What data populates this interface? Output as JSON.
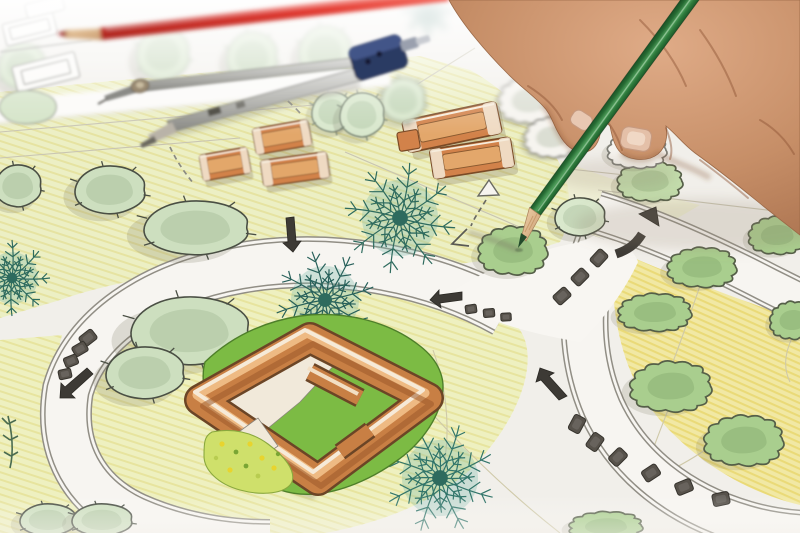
{
  "scene": {
    "type": "photograph",
    "subject": "Hand of a landscape architect drawing a garden design plan with a green colored pencil",
    "tools": {
      "hand": {
        "label": "right hand holding pencil",
        "skin_color": "#c68e67"
      },
      "green_pencil": {
        "label": "green colored pencil",
        "body_color": "#2e7d3c",
        "tip": "sharpened wood tip touching a shrub"
      },
      "red_pencil": {
        "label": "red colored pencil",
        "body_color": "#d93a31"
      },
      "compass": {
        "label": "drafting divider compass",
        "handle_color": "#2c3a63",
        "metal_color": "#b9b9b5"
      }
    },
    "drawing": {
      "label": "hand-drawn landscape architecture blueprint",
      "paper_color": "#f1efea",
      "elements": {
        "lawns": {
          "label": "colored-pencil lawn areas",
          "colors": [
            "#ecefc4",
            "#f1e8a4"
          ]
        },
        "walkways": {
          "label": "curved double-edged walkways",
          "color": "#f7f5f1",
          "edge_color": "#918e85"
        },
        "round_trees": {
          "label": "round canopy trees",
          "fill": "#cddfbf",
          "count": 15
        },
        "scalloped_shrubs": {
          "label": "scalloped green shrubs",
          "fill": "#a9ce8e",
          "count": 9
        },
        "outline_shrubs": {
          "label": "uncolored outline shrubs",
          "fill": "#f6f4ef",
          "count": 5
        },
        "conifers": {
          "label": "feathery conifer plants",
          "color": "#2e6b5e",
          "count": 5
        },
        "building_blocks": {
          "label": "small orange buildings",
          "color": "#d2824a",
          "count": 6
        },
        "courtyard_building": {
          "label": "large orange courtyard building",
          "color": "#c87f44",
          "hedge_color": "#7cbb44"
        },
        "flower_bed": {
          "label": "yellow flower bed",
          "colors": [
            "#cfe06b",
            "#e8d42e"
          ]
        },
        "stepping_stones": {
          "label": "stepping stones",
          "color": "#57524b",
          "count": 16
        },
        "arrows": {
          "label": "hand-sketched direction arrows",
          "color": "#3d3a35",
          "count": 9
        },
        "sketches": {
          "label": "pencil sketches of buildings",
          "color": "#8b8b84"
        }
      }
    }
  }
}
